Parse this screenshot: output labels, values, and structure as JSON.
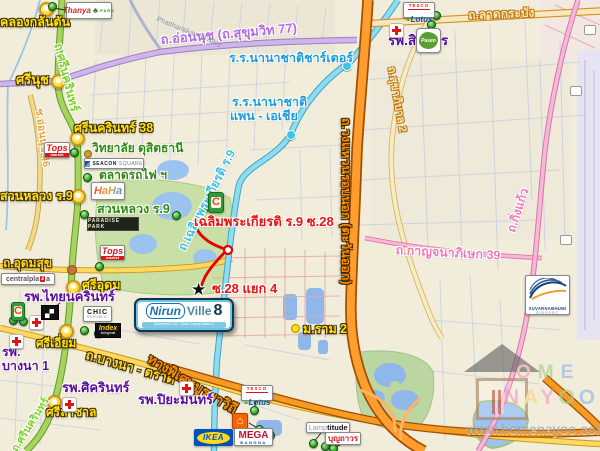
{
  "watermark": {
    "url": "www.homenayoo.com",
    "ome_letters": [
      "O",
      "M",
      "E"
    ],
    "nayoo_letters": [
      "N",
      "A",
      "Y",
      "O",
      "O"
    ]
  },
  "icons": {
    "star": "★",
    "house": "⌂"
  },
  "project_logo": {
    "part1": "Nirun",
    "part2": "Ville",
    "number": "8",
    "tagline": "Sukhumvit 103 - Suan Luang Rama 9"
  },
  "roads": {
    "onnut": "ถ.อ่อนนุช (ถ.สุขุมวิท 77)",
    "srinagarindra_top": "ถ.ศรีนครินทร์",
    "srinagarindra_bottom": "ถ.ศรีนครินทร์",
    "onnut46": "ซ.อ่อนนุช 46",
    "ladkrabang": "ถ.ลาดกระบัง",
    "sukhaphiban2": "ถ.สุขาภิบาล 2",
    "chalermprakiat": "ถ.เฉลิมพระเกียรติ ร.9",
    "udomsuk": "ถ.อุดมสุข",
    "bangna_trat": "ถ.บางนา - ตราด",
    "burapha_withi": "ทางพิเศษบูรพาวิถี",
    "outer_ring": "ถ.วงแหวนรอบนอก (ตะวันออก)",
    "kanchanaphisek39": "ถ.กาญจนาภิเษก 39",
    "kingkaeo": "ถ.กิ่งแก้ว",
    "phatthanakan59": "Phatthanakan 59 Alley"
  },
  "junctions": {
    "klong_kalantan": "คลองกลันตัน",
    "srinut": "ศรีนุช",
    "srinagarindra38": "ศรีนครินทร์ 38",
    "suan_luang_junction": "สวนหลวง ร.9",
    "sri_udom": "ศรีอุดม",
    "sri_iam": "ศรีเอี่ยม",
    "sri_lasalle": "ศรีลาซาล",
    "m_ram2": "ม.ราม 2"
  },
  "hospitals": {
    "sirindhorn": "รพ.สิรินธร",
    "thai_nakarin": "รพ.ไทยนครินทร์",
    "bangna1_line1": "รพ.",
    "bangna1_line2": "บางนา 1",
    "sikarin": "รพ.ศิครินทร์",
    "piyamin": "รพ.ปิยะมินทร์"
  },
  "schools": {
    "charter": "ร.ร.นานาชาติชาร์เตอร์",
    "pan_asia_line1": "ร.ร.นานาชาติ",
    "pan_asia_line2": "แพน - เอเชีย",
    "dusit_thani": "วิทยาลัย ดุสิตธานี"
  },
  "places": {
    "train_market": "ตลาดรถไฟ ฯ",
    "suan_luang_park": "สวนหลวง ร.9"
  },
  "sois": {
    "soi28": "เฉลิมพระเกียรติ ร.9 ซ.28",
    "soi28_yaek4": "ซ.28 แยก 4"
  },
  "logos": {
    "thanya_1": "Thanya",
    "thanya_2": "PARK",
    "thanya_tree": "♣",
    "tesco_1": "TESCO",
    "tesco_2": "Lotus",
    "tesco_leaf": "❧",
    "tops_1": "Tops",
    "tops_2": "market",
    "seacon_1": "SEACON",
    "seacon_2": "SQUARE",
    "haha": "HaHa",
    "paradise": "PARADISE PARK",
    "central_1": "central",
    "central_2": "pla",
    "central_3": "z",
    "central_4": "a",
    "bigc": "C",
    "chic_1": "CHIC",
    "chic_2": "REPUBLIC",
    "index_1": "Index",
    "index_2": "livingmall",
    "ikea": "IKEA",
    "mega_1": "MEGA",
    "mega_2": "BANGNA",
    "lamp_1": "Lamp",
    "lamp_2": "titude",
    "boonthavorn": "บุญถาวร",
    "paseo": "Paseo",
    "suvarn_1": "SUVARNABHUMI",
    "suvarn_2": "AIRPORT"
  },
  "colors": {
    "ring_road_orange": "#ff9d2e",
    "expressway_orange": "#f59a23",
    "road_yellow": "#ffd95e",
    "road_green": "#a6d45e",
    "road_cyan": "#8fdcf0",
    "road_violet": "#cfb5ea",
    "road_pink": "#f6b8d8",
    "route_red": "#e60000",
    "junction_label_yellow": "#ffe013",
    "hospital_purple": "#5c0d9e",
    "school_blue": "#1e9cd8",
    "place_green": "#2f8a10"
  }
}
